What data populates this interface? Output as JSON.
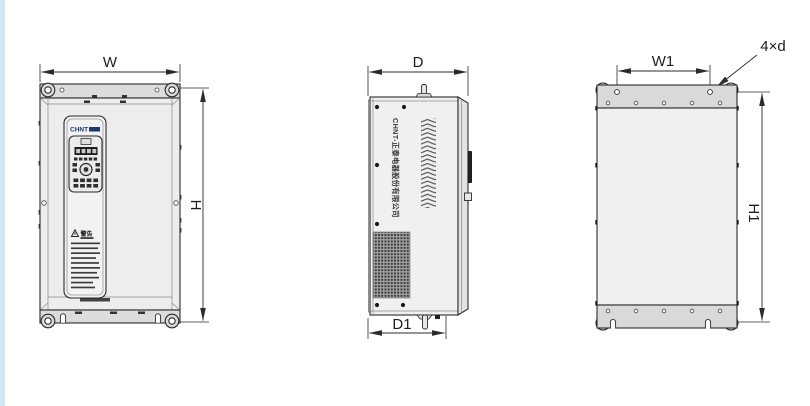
{
  "canvas": {
    "width": 810,
    "height": 406,
    "background": "#ffffff",
    "accent_stripe_color": "#cfe9f5",
    "line_color": "#2b2b2b",
    "panel_fill": "#efefef",
    "plate_fill": "#d9d9d9"
  },
  "icons": {
    "warning_triangle": "⚠",
    "mounting_eyelet": "◎"
  },
  "drawing": {
    "front_view": {
      "dim_width": "W",
      "dim_height": "H",
      "logo": "CHNT",
      "warning_title": "警告"
    },
    "side_view": {
      "dim_depth": "D",
      "dim_depth_mount": "D1",
      "brand_text": "CHNT-正泰电器股份有限公司"
    },
    "back_view": {
      "dim_width_mount": "W1",
      "dim_height_mount": "H1",
      "mount_holes_note": "4×d"
    }
  }
}
